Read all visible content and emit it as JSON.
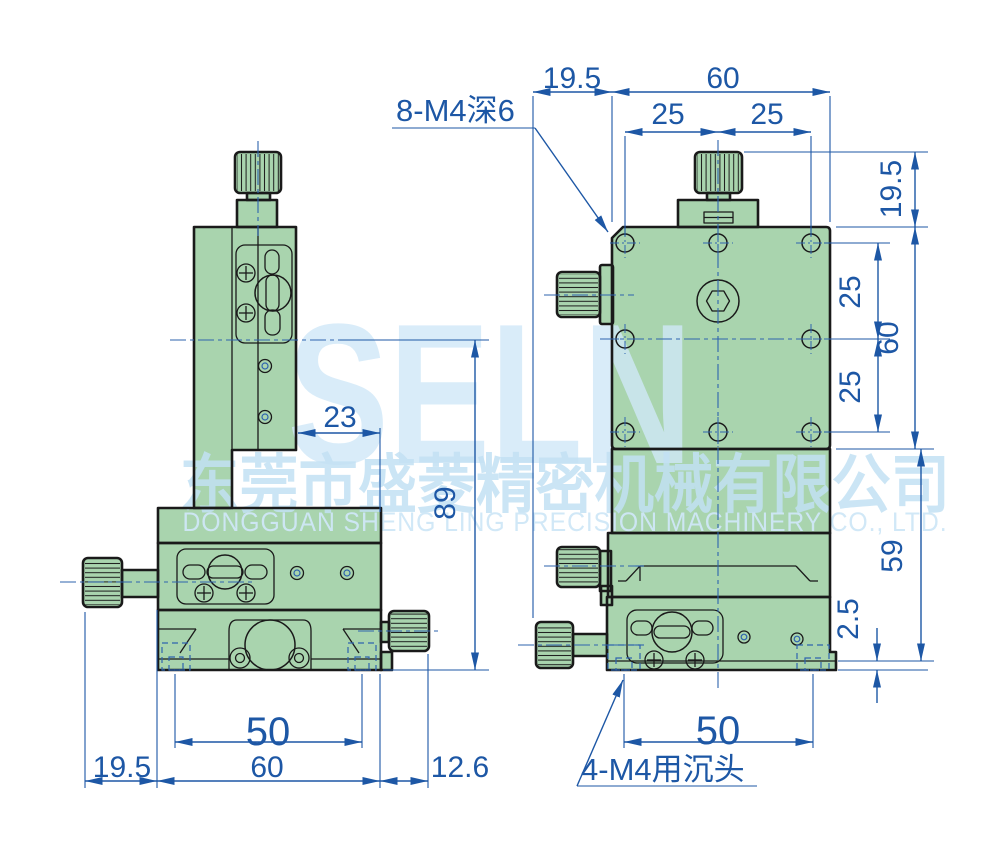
{
  "watermark": {
    "logo": "SELN",
    "company_cn": "东莞市盛菱精密机械有限公司",
    "company_en": "DONGGUAN SHENG LING PRECISION MACHINERY CO., LTD."
  },
  "annotations": {
    "tapped_holes_note": "8-M4深6",
    "counterbore_note": "4-M4用沉头"
  },
  "front_view": {
    "dims": {
      "top_offset": "19.5",
      "top_width": "60",
      "top_hole_left": "25",
      "top_hole_right": "25",
      "knob_height": "19.5",
      "hole_row_upper": "25",
      "body_height": "60",
      "hole_row_lower": "25",
      "lower_body_height": "59",
      "base_lip": "2.5",
      "base_hole_span": "50"
    }
  },
  "side_view": {
    "dims": {
      "carriage_offset": "23",
      "overall_height": "89",
      "base_hole_span": "50",
      "knob_offset": "19.5",
      "base_width": "60",
      "knob_width": "12.6"
    }
  },
  "colors": {
    "body_green": "#a9d4ae",
    "dim_blue": "#1d57a5",
    "centerline_blue": "#2e63ae",
    "outline_dark": "#1a1a1a",
    "watermark_blue": "#cfe7f7"
  }
}
